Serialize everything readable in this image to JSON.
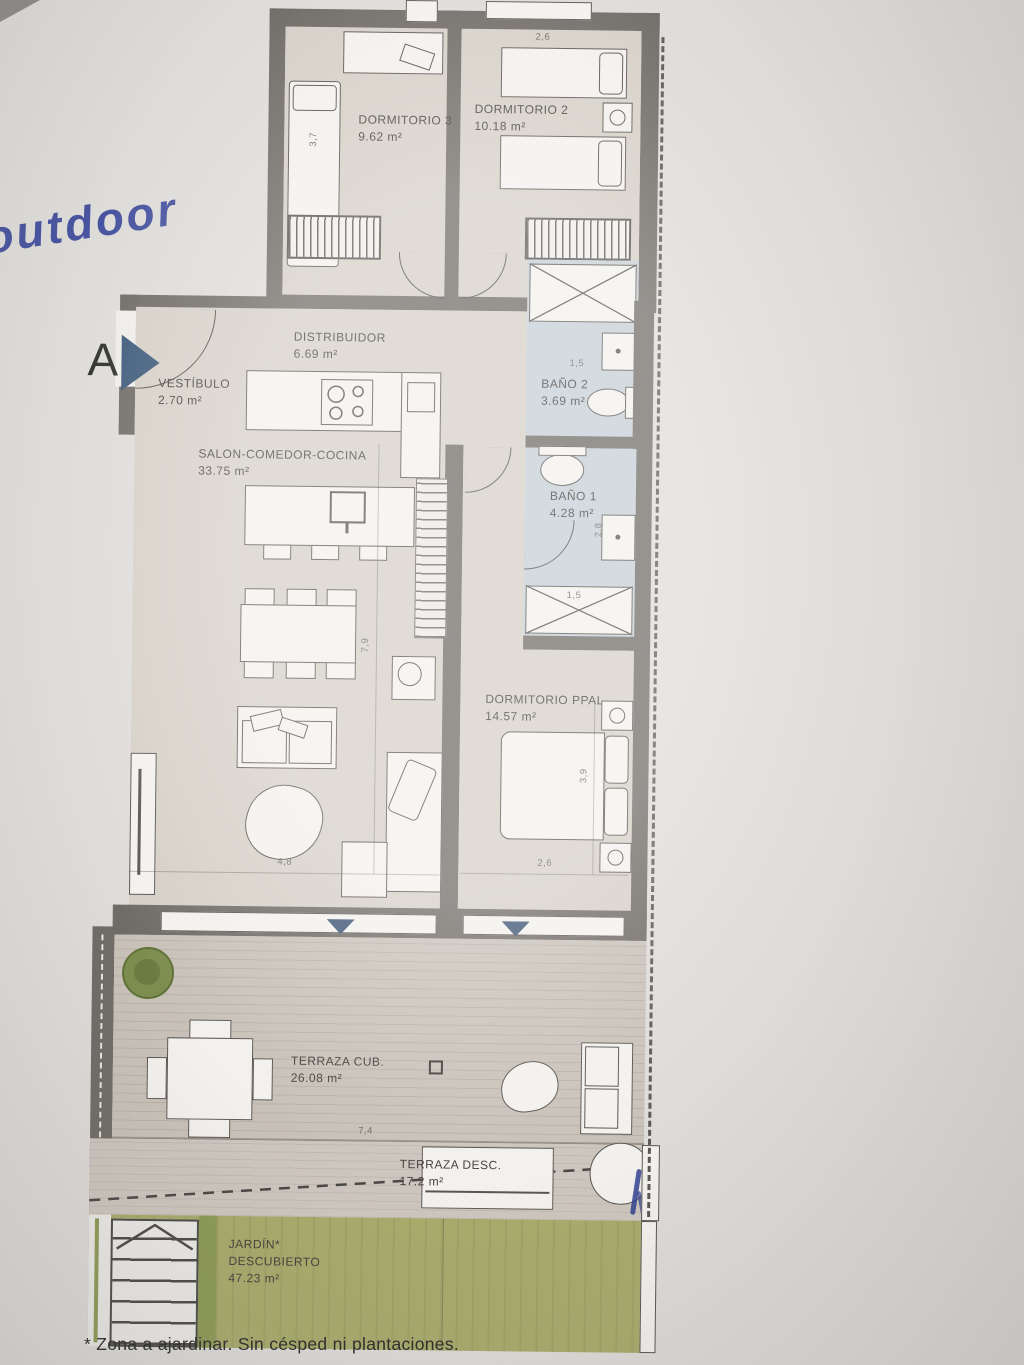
{
  "annotations": {
    "handwritten_note": "outdoor",
    "section_marker": "A",
    "footnote": "* Zona a ajardinar. Sin césped ni plantaciones."
  },
  "rooms": {
    "dorm3": {
      "name": "DORMITORIO 3",
      "area": "9.62 m²"
    },
    "dorm2": {
      "name": "DORMITORIO 2",
      "area": "10.18 m²"
    },
    "distribuidor": {
      "name": "DISTRIBUIDOR",
      "area": "6.69 m²"
    },
    "vestibulo": {
      "name": "VESTÍBULO",
      "area": "2.70 m²"
    },
    "bano2": {
      "name": "BAÑO 2",
      "area": "3.69 m²"
    },
    "salon": {
      "name": "SALON-COMEDOR-COCINA",
      "area": "33.75 m²"
    },
    "bano1": {
      "name": "BAÑO 1",
      "area": "4.28 m²"
    },
    "ppal": {
      "name": "DORMITORIO PPAL",
      "area": "14.57 m²"
    },
    "terraza_cub": {
      "name": "TERRAZA CUB.",
      "area": "26.08 m²"
    },
    "terraza_desc": {
      "name": "TERRAZA DESC.",
      "area": "17.2 m²"
    },
    "jardin": {
      "name": "JARDÍN*",
      "name2": "DESCUBIERTO",
      "area": "47.23 m²"
    }
  },
  "dimensions": {
    "dorm2_width": "2,6",
    "dorm3_depth": "3,7",
    "bano2_width": "1,5",
    "bano1_depth": "2,8",
    "bano1_shower": "1,5",
    "salon_depth": "7,9",
    "salon_width": "4,8",
    "ppal_depth": "3,9",
    "ppal_width": "2,6",
    "terraza_width": "7,4"
  },
  "colors": {
    "wall": "#6f6b66",
    "floor": "#d5cfc6",
    "bath": "#c5ced6",
    "garden": "#a8ab6b",
    "ink_blue": "#2e3d96",
    "marker_blue": "#3e5474"
  }
}
